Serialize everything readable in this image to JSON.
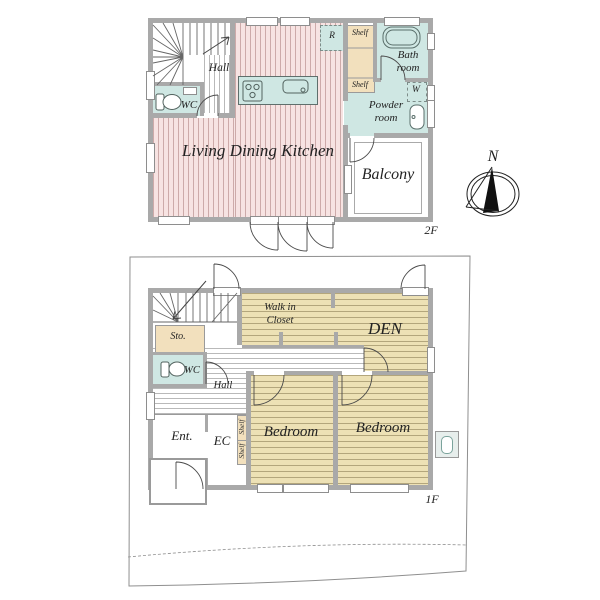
{
  "floor2": {
    "floor_label": "2F",
    "hall": "Hall",
    "wc": "WC",
    "living_dining_kitchen": "Living Dining Kitchen",
    "refrigerator": "R",
    "shelf_top": "Shelf",
    "shelf_bottom": "Shelf",
    "bath_room": "Bath room",
    "washer": "W",
    "powder_room": "Powder room",
    "balcony": "Balcony"
  },
  "floor1": {
    "floor_label": "1F",
    "walk_in_closet": "Walk in Closet",
    "den": "DEN",
    "storage": "Sto.",
    "wc": "WC",
    "hall": "Hall",
    "entrance": "Ent.",
    "entrance_closet": "EC",
    "shelf_upper": "Shelf",
    "shelf_lower": "Shelf",
    "bedroom_left": "Bedroom",
    "bedroom_right": "Bedroom"
  },
  "compass": {
    "north": "N"
  },
  "colors": {
    "wall_gray": "#a9a9a9",
    "ldk_pink": "#f7e3e2",
    "water_teal": "#cfe7e3",
    "shelf_tan": "#f2e0bd",
    "bedroom_tan": "#ede1b5"
  }
}
